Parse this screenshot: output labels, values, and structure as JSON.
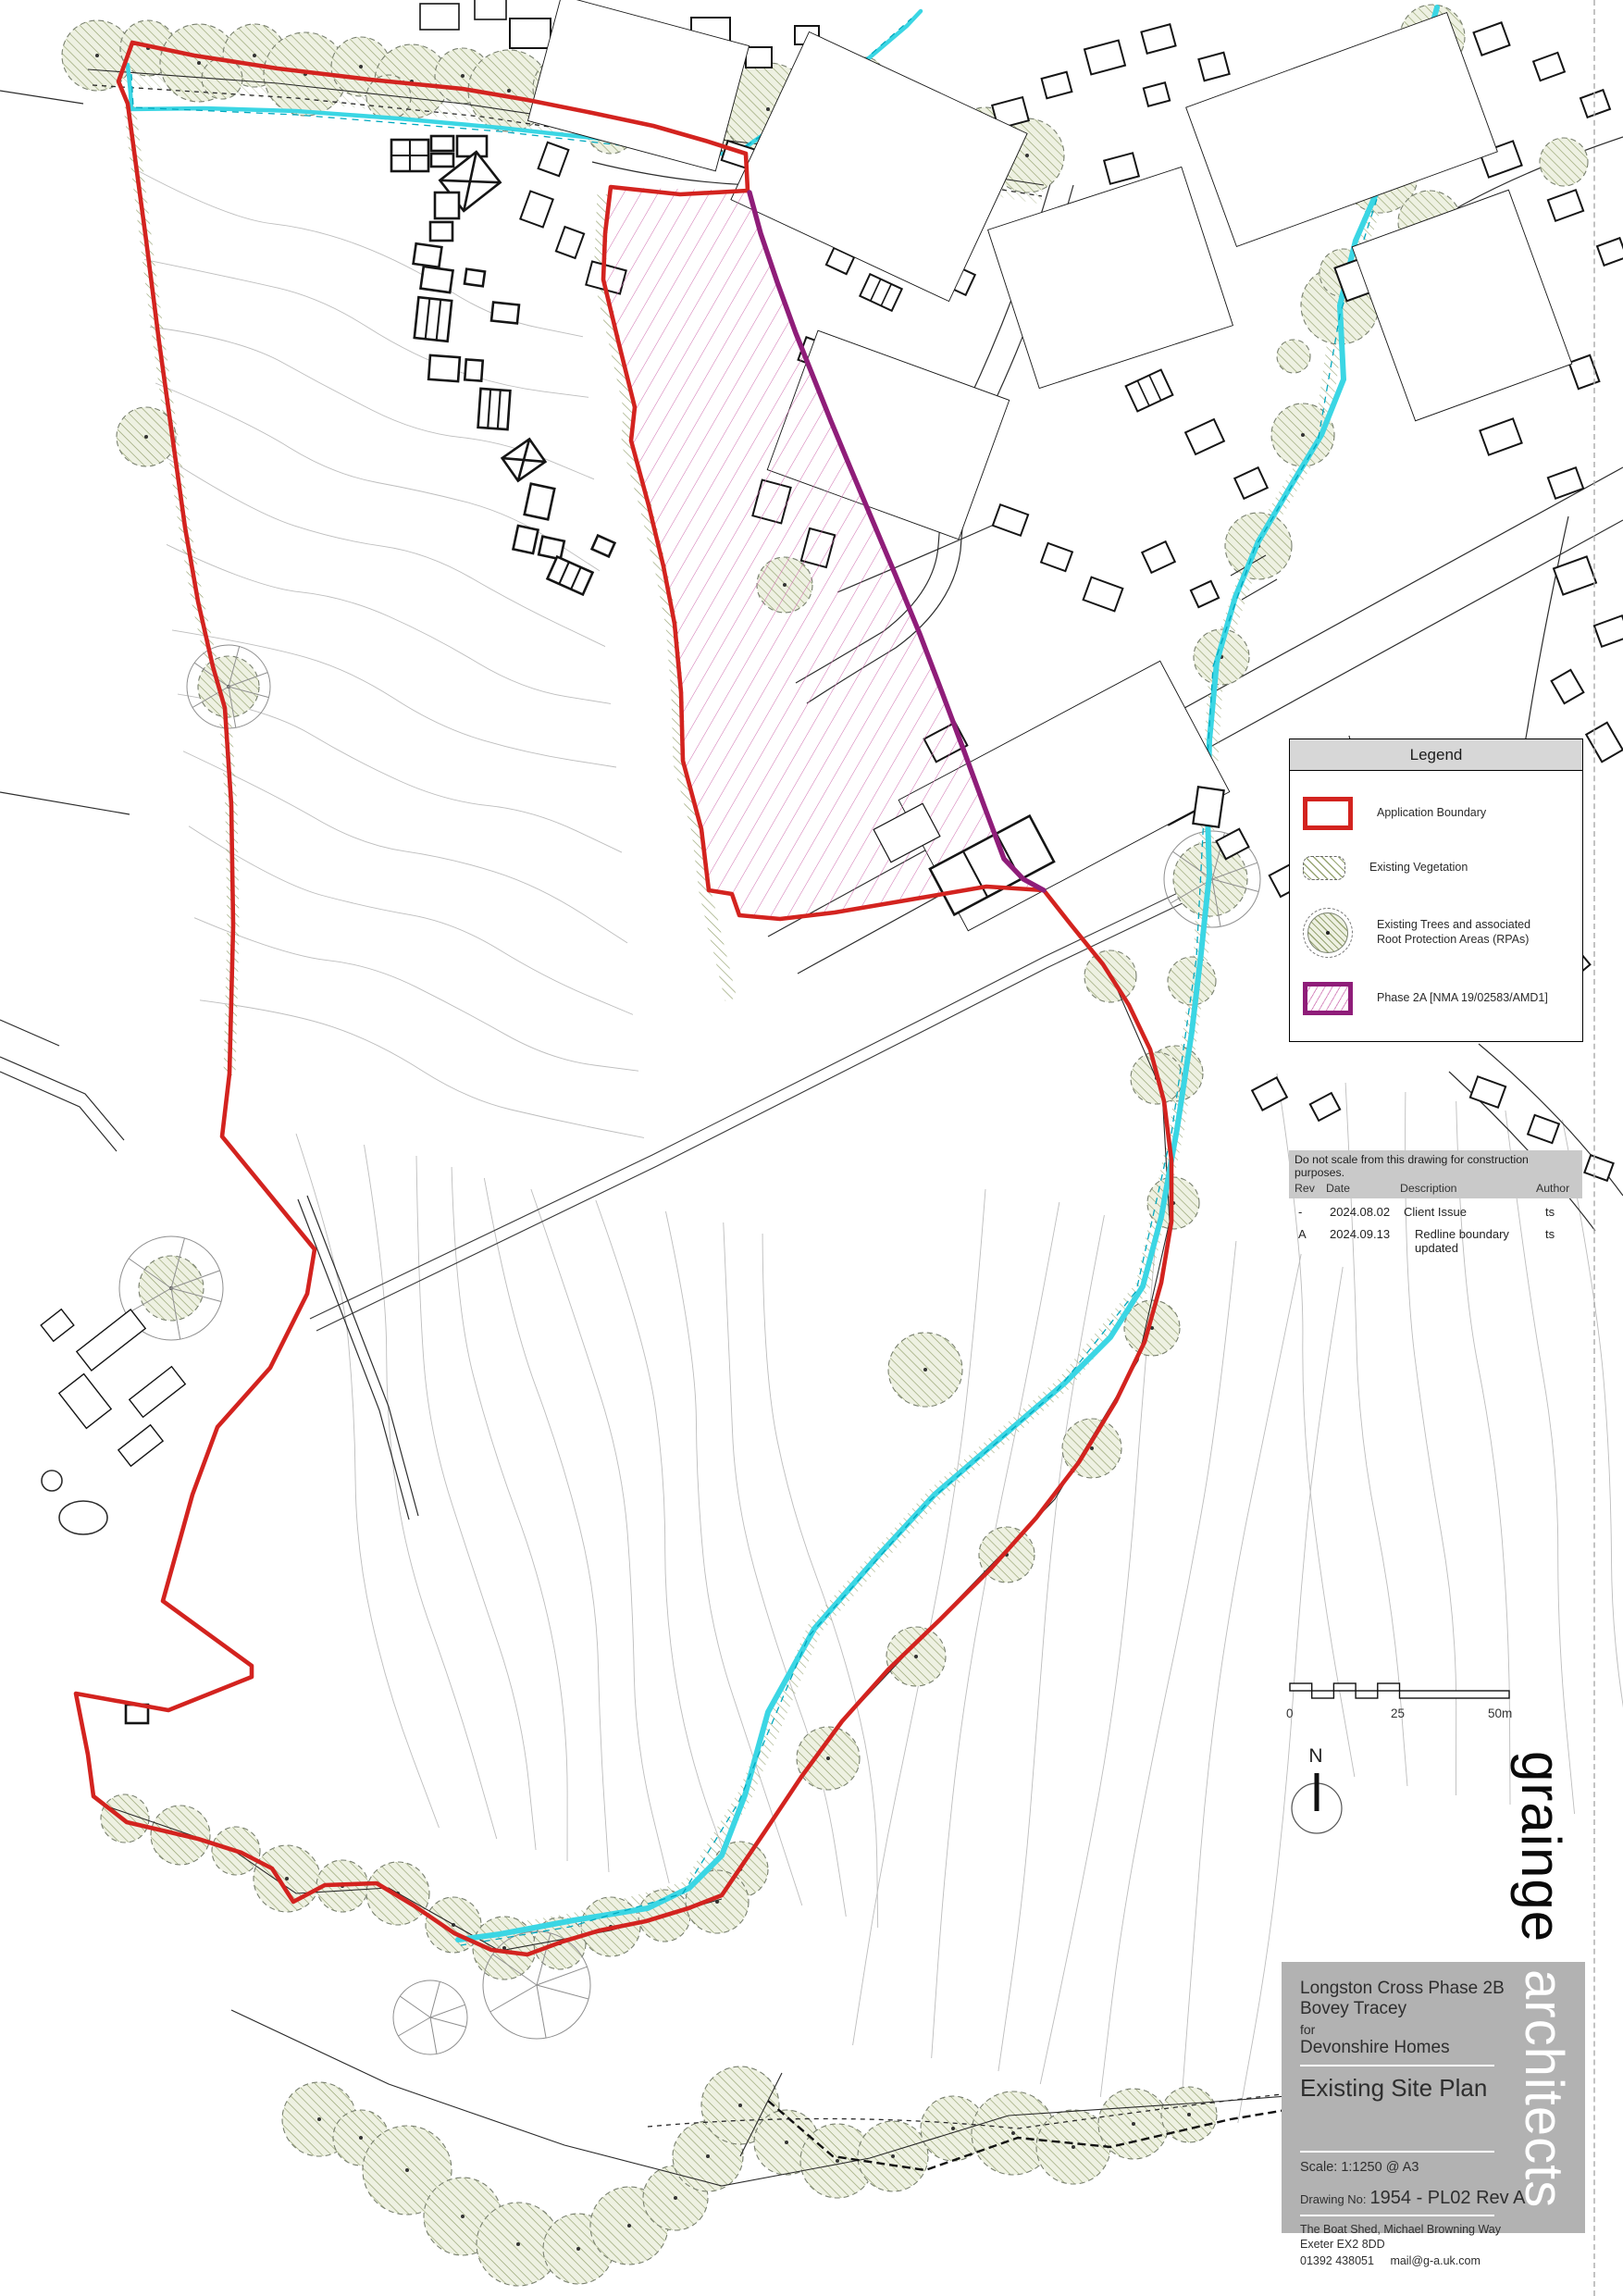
{
  "legend": {
    "title": "Legend",
    "items": [
      {
        "icon": "application-boundary-swatch",
        "label": "Application Boundary"
      },
      {
        "icon": "existing-vegetation-swatch",
        "label": "Existing Vegetation"
      },
      {
        "icon": "existing-trees-rpa-swatch",
        "label_line1": "Existing Trees and associated",
        "label_line2": "Root Protection Areas (RPAs)"
      },
      {
        "icon": "phase-2a-swatch",
        "label": "Phase 2A [NMA 19/02583/AMD1]"
      }
    ]
  },
  "revision_table": {
    "disclaimer": "Do not scale from this drawing for construction purposes.",
    "headers": [
      "Rev",
      "Date",
      "Description",
      "Author"
    ],
    "rows": [
      {
        "rev": "-",
        "date": "2024.08.02",
        "description": "Client Issue",
        "author": "ts"
      },
      {
        "rev": "A",
        "date": "2024.09.13",
        "description": "Redline boundary updated",
        "author": "ts"
      }
    ]
  },
  "scale_bar": {
    "labels": [
      "0",
      "25",
      "50m"
    ]
  },
  "north_arrow": {
    "label": "N"
  },
  "title_block": {
    "project_line1": "Longston Cross Phase 2B",
    "project_line2": "Bovey Tracey",
    "for_label": "for",
    "client": "Devonshire Homes",
    "drawing_title": "Existing Site Plan",
    "scale_label": "Scale: 1:1250 @ A3",
    "drawing_no_label": "Drawing No:",
    "drawing_no": "1954 - PL02 Rev A",
    "address_line1": "The Boat Shed, Michael Browning Way",
    "address_line2": "Exeter EX2 8DD",
    "phone": "01392 438051",
    "email": "mail@g-a.uk.com"
  },
  "brand": {
    "word1": "grainge",
    "word2": "architects"
  },
  "colors": {
    "application_boundary": "#d3231f",
    "phase_2a_boundary": "#8f1d79",
    "watercourse": "#3bd6e4",
    "vegetation_hatch": "#93a06e",
    "contour": "#bdbdbd",
    "panel_grey": "#b2b2b2",
    "band_grey": "#c9c9c9",
    "legend_header_grey": "#d7d7d7"
  }
}
